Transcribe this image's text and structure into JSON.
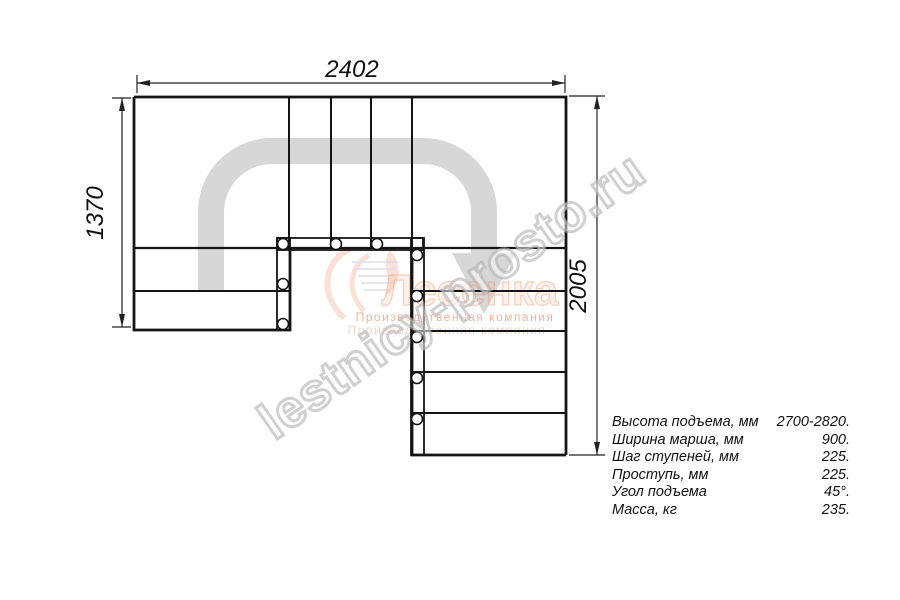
{
  "drawing": {
    "title": "stair-plan-top-view",
    "dim_top": "2402",
    "dim_left": "1370",
    "dim_right": "2005"
  },
  "specs": {
    "rows": [
      {
        "label": "Высота подъема, мм",
        "value": "2700-2820."
      },
      {
        "label": "Ширина марша, мм",
        "value": "900."
      },
      {
        "label": "Шаг ступеней, мм",
        "value": "225."
      },
      {
        "label": "Проступь, мм",
        "value": "225."
      },
      {
        "label": "Угол подъема",
        "value": "45°."
      },
      {
        "label": "Масса, кг",
        "value": "235."
      }
    ]
  },
  "watermark": {
    "site": "lestnicy-prosto.ru",
    "brand": "Лесенка",
    "company": "Производственная компания"
  },
  "colors": {
    "line": "#141414",
    "dim_line": "#222222",
    "arrow_gray": "#d7d7d7",
    "accent_orange": "#ee8155",
    "accent_orange_faint": "rgba(238,129,85,0.45)",
    "brand_fill": "rgba(244,166,126,0.16)",
    "brand_stroke": "rgba(234,136,94,0.35)",
    "hatch_gray": "#c6c6cf",
    "watermark_gray": "#b0b0b0"
  }
}
